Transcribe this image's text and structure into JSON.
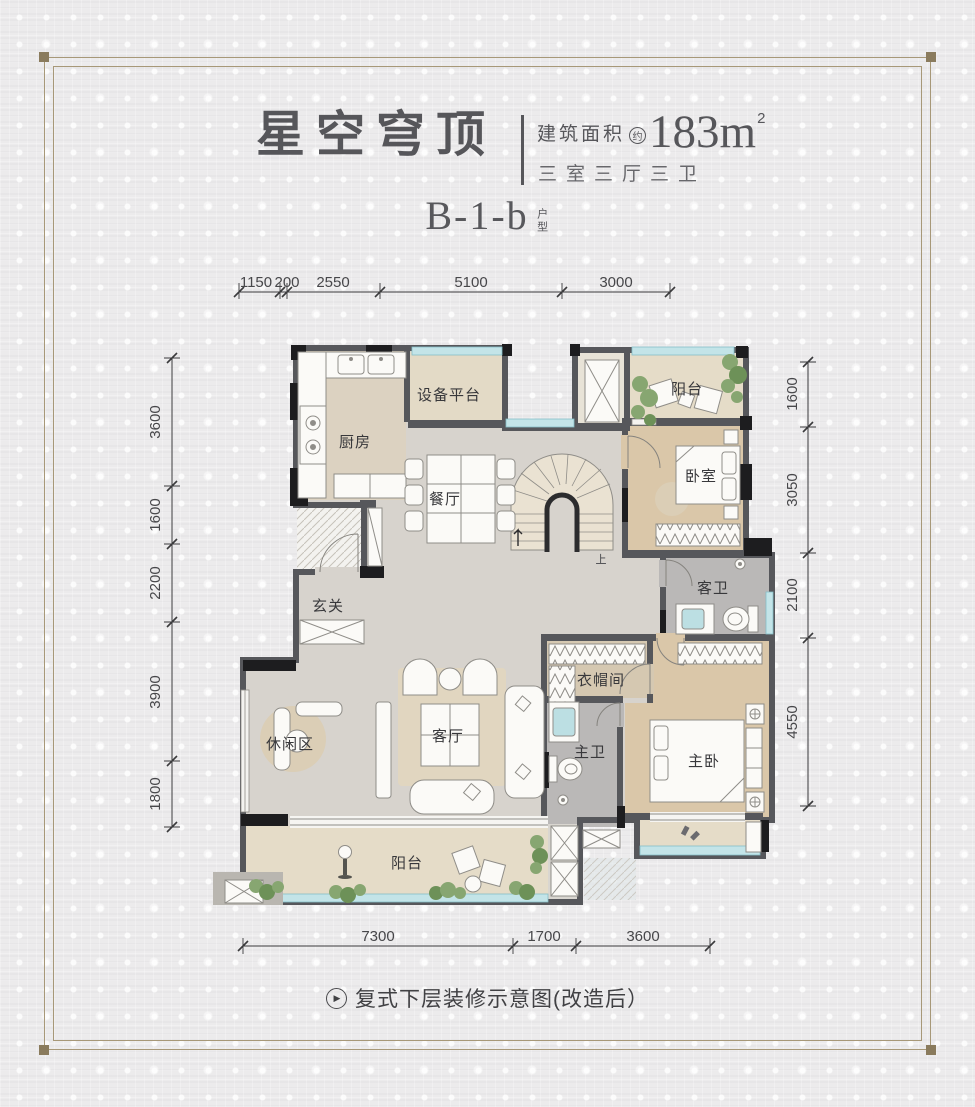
{
  "header": {
    "title": "星空穹顶",
    "area_label": "建筑面积",
    "area_approx": "约",
    "area_value": "183m",
    "area_sup": "2",
    "spec": "三室三厅三卫",
    "unit_code": "B-1-b",
    "unit_suffix": "户型"
  },
  "rooms": {
    "kitchen": "厨房",
    "equipment_platform": "设备平台",
    "balcony_top": "阳台",
    "bedroom": "卧室",
    "dining": "餐厅",
    "foyer": "玄关",
    "guest_bath": "客卫",
    "cloakroom": "衣帽间",
    "leisure": "休闲区",
    "living": "客厅",
    "master_bath": "主卫",
    "master_bedroom": "主卧",
    "balcony_bottom": "阳台",
    "stair_up": "上"
  },
  "dims": {
    "top": [
      "1150",
      "200",
      "2550",
      "5100",
      "3000"
    ],
    "left": [
      "3600",
      "1600",
      "2200",
      "3900",
      "1800"
    ],
    "right": [
      "1600",
      "3050",
      "2100",
      "4550"
    ],
    "bottom": [
      "7300",
      "1700",
      "3600"
    ]
  },
  "caption": {
    "icon_glyph": "▶",
    "text": "复式下层装修示意图(改造后）"
  },
  "colors": {
    "wall": "#56575b",
    "wall_black": "#1d1d1f",
    "glass": "#c3e4e8",
    "wood_floor": "#dac7a9",
    "marble_floor": "#d7d3cd",
    "bath_floor": "#bab8b7",
    "balcony_floor": "#e5dcc8",
    "frame": "#a79878",
    "title_text": "#56565a"
  }
}
